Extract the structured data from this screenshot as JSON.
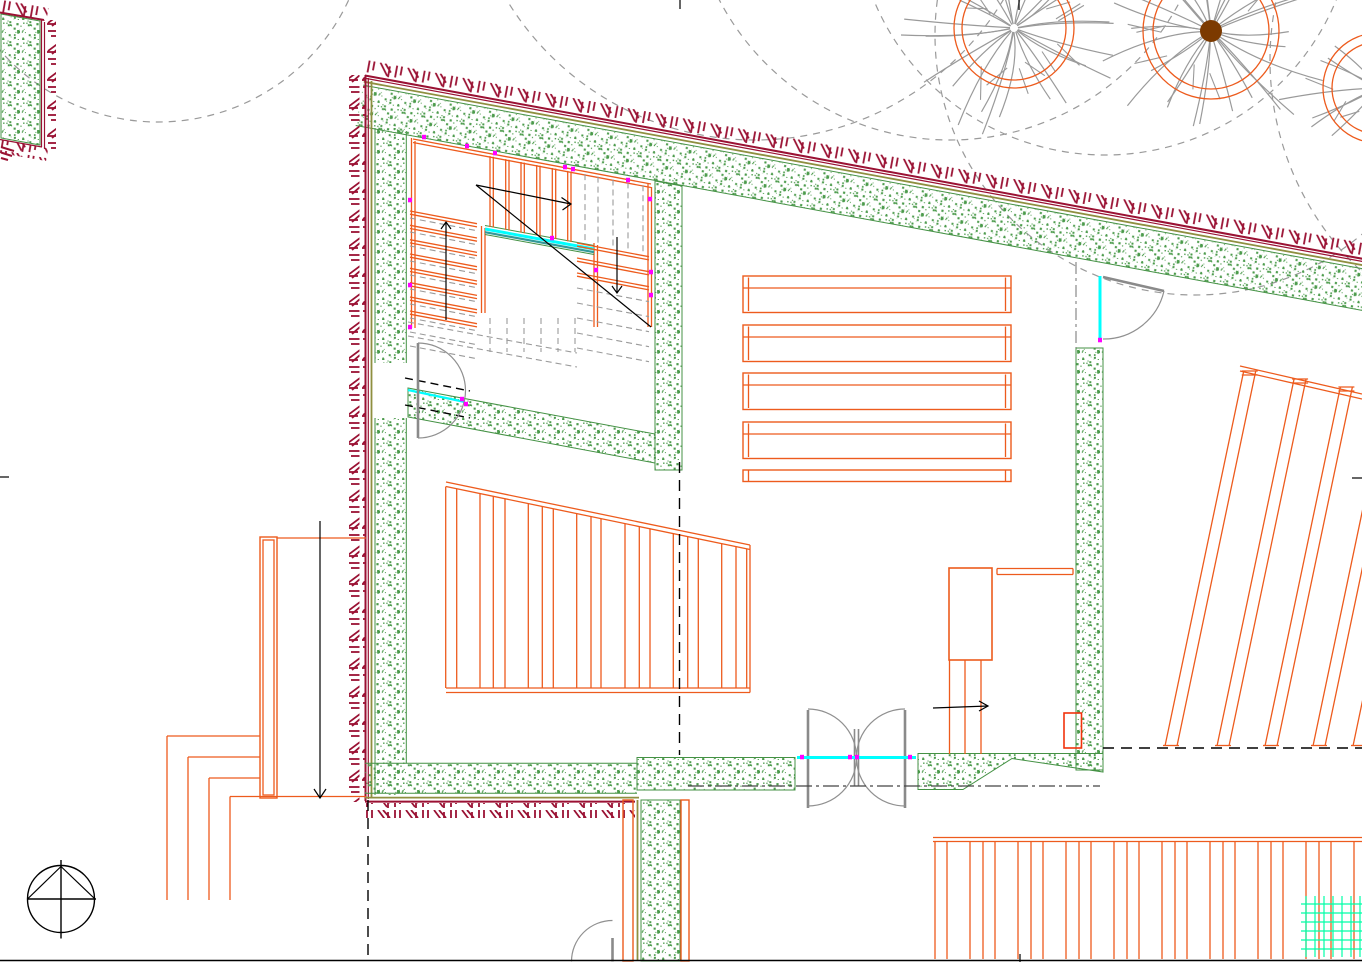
{
  "meta": {
    "description": "CAD architectural floor plan viewport - ground floor with U-shaped stair, rooms with decking, trees with canopies, north arrow",
    "visible_text": "none"
  },
  "colors": {
    "orange": "#ED5B1D",
    "orangeRed": "#F2330D",
    "maroon": "#9A1133",
    "olive": "#8F8F40",
    "green": "#4C9B4C",
    "greenEdge": "#449144",
    "teal": "#339999",
    "cyan": "#00FFFF",
    "magenta": "#FF00FF",
    "grayDoor": "#8A8A8A",
    "grayArc": "#909090",
    "grayDash": "#9A9A9A",
    "canopy": "#9A9A9A",
    "branch": "#9A9A9A",
    "brown": "#7C3A00",
    "spring": "#00FFA8",
    "black": "#000000"
  },
  "canopies": [
    {
      "cx": 158,
      "cy": -88,
      "r": 210
    },
    {
      "cx": 755,
      "cy": -150,
      "r": 290
    },
    {
      "cx": 950,
      "cy": -120,
      "r": 260
    },
    {
      "cx": 1105,
      "cy": -95,
      "r": 250
    },
    {
      "cx": 1195,
      "cy": 35,
      "r": 260
    },
    {
      "cx": 1560,
      "cy": 60,
      "r": 290
    }
  ],
  "trees": [
    {
      "cx": 1014,
      "cy": 28,
      "rInner": 52,
      "rOuter": 60,
      "rBranch": 108,
      "branches": 26,
      "dot": 0
    },
    {
      "cx": 1211,
      "cy": 31,
      "rInner": 58,
      "rOuter": 68,
      "rBranch": 125,
      "branches": 28,
      "dot": 11
    },
    {
      "cx": 1378,
      "cy": 88,
      "rInner": 46,
      "rOuter": 55,
      "rBranch": 95,
      "branches": 20,
      "dot": 9
    }
  ],
  "stairs": {
    "slope": 0.19,
    "topTreadsX": [
      490,
      493.3,
      505.7,
      509,
      521,
      524.3,
      536.7,
      540,
      552.3,
      555.7,
      567.7,
      571
    ],
    "topDashedX": [
      585,
      598,
      613,
      628,
      643
    ],
    "leftTreadsY": [
      211,
      225.3,
      239.7,
      254,
      268.3,
      282.7,
      297,
      311
    ],
    "leftDashedY": [
      218,
      232,
      246,
      261,
      275,
      289,
      304,
      318,
      332,
      346
    ],
    "rightTreadsY": [
      243,
      258,
      273
    ],
    "rightDashedY": [
      288,
      303,
      318,
      333,
      348
    ],
    "underDashedX": [
      490,
      507,
      524,
      541,
      558,
      575
    ]
  },
  "magentaTicks": [
    [
      424,
      137
    ],
    [
      467,
      146
    ],
    [
      495,
      153
    ],
    [
      565,
      167
    ],
    [
      573,
      169
    ],
    [
      628,
      180
    ],
    [
      410,
      200
    ],
    [
      410,
      285
    ],
    [
      410,
      327
    ],
    [
      650,
      199
    ],
    [
      651,
      272
    ],
    [
      651,
      295
    ],
    [
      552,
      238
    ],
    [
      596,
      270
    ],
    [
      462,
      399
    ],
    [
      466,
      404
    ],
    [
      1100,
      340
    ],
    [
      802,
      757
    ],
    [
      850,
      757
    ],
    [
      857,
      757
    ],
    [
      910,
      757
    ]
  ],
  "bedBands": {
    "x": 743,
    "w": 268,
    "tops": [
      276,
      325,
      373,
      422
    ],
    "h": 36.5,
    "innerOffset": 12,
    "closer": [
      470,
      11.5
    ]
  },
  "leftDecking": {
    "x0": 446,
    "x1": 750,
    "yTop": 482,
    "slope": 0.2073,
    "yBottom": 688,
    "lines": [
      445.7,
      456.7,
      480,
      493.3,
      505,
      528.3,
      542.3,
      553.3,
      576.7,
      591,
      601,
      625,
      639.3,
      650,
      673.3,
      687.7,
      698.3,
      721.7,
      736,
      746.7
    ]
  },
  "rightDecking": {
    "floorY": 746,
    "lean": 0.21,
    "topLine": [
      1240,
      366,
      1362,
      394
    ],
    "pairs": [
      [
        1165,
        1177,
        371
      ],
      [
        1217,
        1229,
        379
      ],
      [
        1265,
        1277,
        387
      ],
      [
        1313,
        1325,
        392
      ],
      [
        1353,
        1365,
        397
      ]
    ]
  },
  "bottomDecking": {
    "yTop1": 837.5,
    "yTop2": 841.5,
    "x0": 933,
    "x1": 1362,
    "yBot": 959,
    "groupStarts": [
      935,
      983,
      1031,
      1079,
      1127,
      1175,
      1223,
      1271,
      1319
    ],
    "offsets": [
      0,
      12,
      35
    ]
  },
  "terrace": {
    "outerRect": [
      260,
      537,
      17,
      261
    ],
    "innerRect": [
      263,
      540,
      11,
      255
    ],
    "topLine": [
      277,
      538,
      366,
      538
    ],
    "steps": [
      [
        167,
        736
      ],
      [
        188,
        757
      ],
      [
        209,
        778
      ],
      [
        230,
        796.5
      ]
    ],
    "stepEndX": 260,
    "lastEndX": 366,
    "vertEndY": 900,
    "arrow": [
      320,
      521,
      320,
      798
    ]
  },
  "greenGrid": {
    "x0": 1301,
    "x1": 1362,
    "y0": 896,
    "y1": 957,
    "hYs": [
      904,
      913,
      922,
      931,
      940,
      949
    ],
    "vXs": [
      1306,
      1315,
      1324,
      1333,
      1342,
      1351,
      1360
    ]
  }
}
